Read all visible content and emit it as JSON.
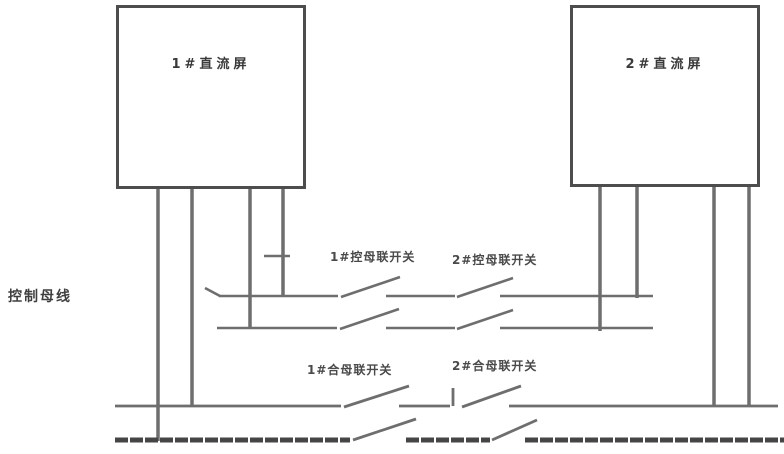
{
  "diagram": {
    "boxes": [
      {
        "id": "dc-panel-1",
        "label": "1#直流屏"
      },
      {
        "id": "dc-panel-2",
        "label": "2#直流屏"
      }
    ],
    "bus_labels": {
      "control_bus": "控制母线"
    },
    "switch_labels": {
      "control_tie_1": "1#控母联开关",
      "control_tie_2": "2#控母联开关",
      "closing_tie_1": "1#合母联开关",
      "closing_tie_2": "2#合母联开关"
    },
    "colors": {
      "line": "#6e6e6e",
      "line_dark": "#454545",
      "border": "#4d4d4d",
      "text": "#4a4a4a",
      "background": "#ffffff"
    }
  }
}
